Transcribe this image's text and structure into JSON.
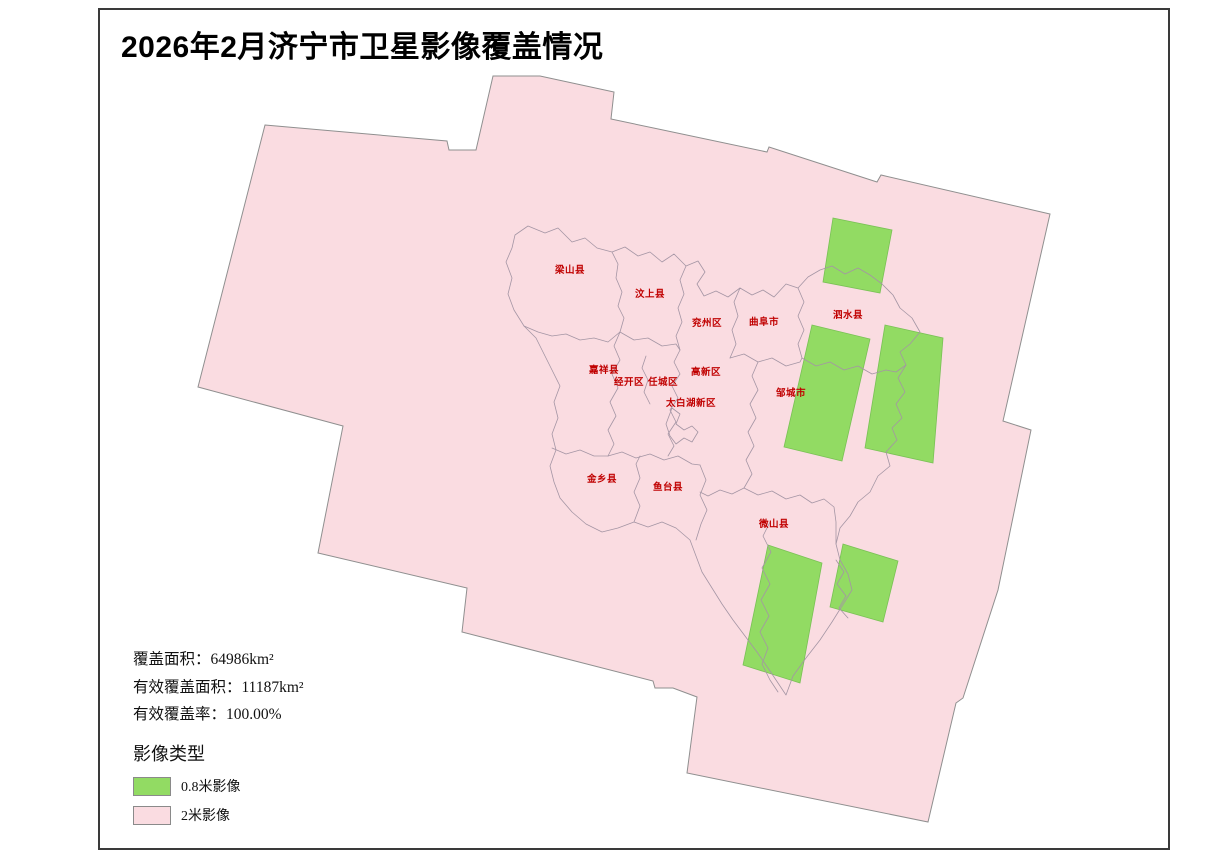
{
  "title": "2026年2月济宁市卫星影像覆盖情况",
  "stats": {
    "coverage_area": "覆盖面积：64986km²",
    "effective_coverage_area": "有效覆盖面积：11187km²",
    "effective_coverage_rate": "有效覆盖率：100.00%"
  },
  "legend": {
    "title": "影像类型",
    "items": [
      {
        "label": "0.8米影像",
        "color": "#92db63"
      },
      {
        "label": "2米影像",
        "color": "#fadce1"
      }
    ]
  },
  "map": {
    "districts": [
      {
        "name": "梁山县"
      },
      {
        "name": "汶上县"
      },
      {
        "name": "兖州区"
      },
      {
        "name": "曲阜市"
      },
      {
        "name": "泗水县"
      },
      {
        "name": "嘉祥县"
      },
      {
        "name": "经开区"
      },
      {
        "name": "任城区"
      },
      {
        "name": "高新区"
      },
      {
        "name": "邹城市"
      },
      {
        "name": "太白湖新区"
      },
      {
        "name": "金乡县"
      },
      {
        "name": "鱼台县"
      },
      {
        "name": "微山县"
      }
    ]
  },
  "colors": {
    "image_08m_fill": "#92db63",
    "image_2m_fill": "#fadce1",
    "district_label": "#c00000",
    "boundary_line": "#a495a4",
    "footprint_outline": "#8f8f8f",
    "frame_border": "#3a3a3a"
  }
}
